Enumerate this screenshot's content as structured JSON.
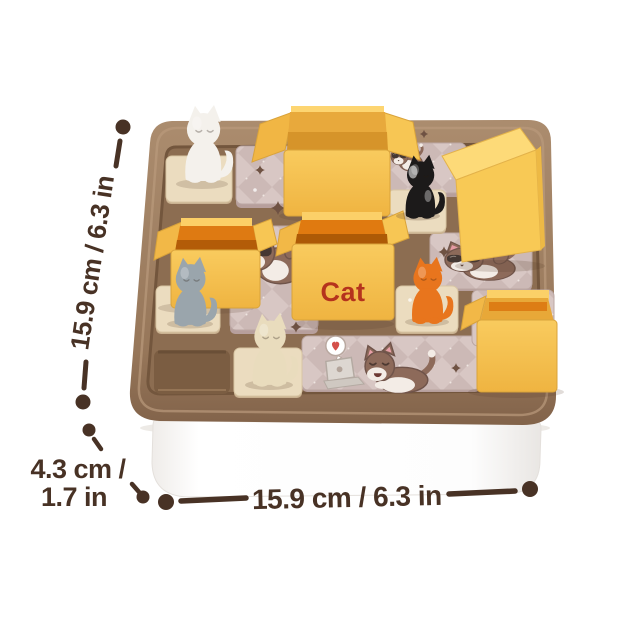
{
  "image": {
    "description": "Product photo of a cat-themed sliding puzzle board game with printed size callouts",
    "background_color": "#ffffff"
  },
  "annotations": {
    "color": "#483225",
    "left_dimension": {
      "label": "15.9 cm / 6.3 in"
    },
    "height_dimension": {
      "line1": "4.3 cm /",
      "line2": "1.7 in"
    },
    "bottom_dimension": {
      "label": "15.9 cm / 6.3 in"
    }
  },
  "board": {
    "cat_box_label": "Cat",
    "cat_box_label_color": "#b5331d",
    "tray_color": "#9c7c5f",
    "floor_color": "#8c6d51",
    "storage_base_color": "#ffffff",
    "tile_pink_color": "#d8c7c4",
    "tile_cream_color": "#ebdcbf",
    "box_yellow_color": "#f6c24c",
    "box_interior_orange_color": "#e07a10",
    "figurines": [
      {
        "name": "white-cat",
        "color": "#f4f1ec"
      },
      {
        "name": "gray-cat",
        "color": "#9aa5ac"
      },
      {
        "name": "black-cat",
        "color": "#1c1a1a"
      },
      {
        "name": "orange-cat",
        "color": "#e8751d"
      },
      {
        "name": "cream-cat",
        "color": "#e9dcbd"
      }
    ],
    "boxes": [
      "open-flap-box-top-center",
      "open-box-left",
      "cat-label-box-center",
      "solid-yellow-block-top-right",
      "open-box-bottom-right"
    ],
    "tile_art": [
      "paw-print",
      "cat-with-sunglasses-left",
      "cat-with-sunglasses-right",
      "cat-with-laptop",
      "heart-speech-bubble",
      "sparkles"
    ]
  }
}
